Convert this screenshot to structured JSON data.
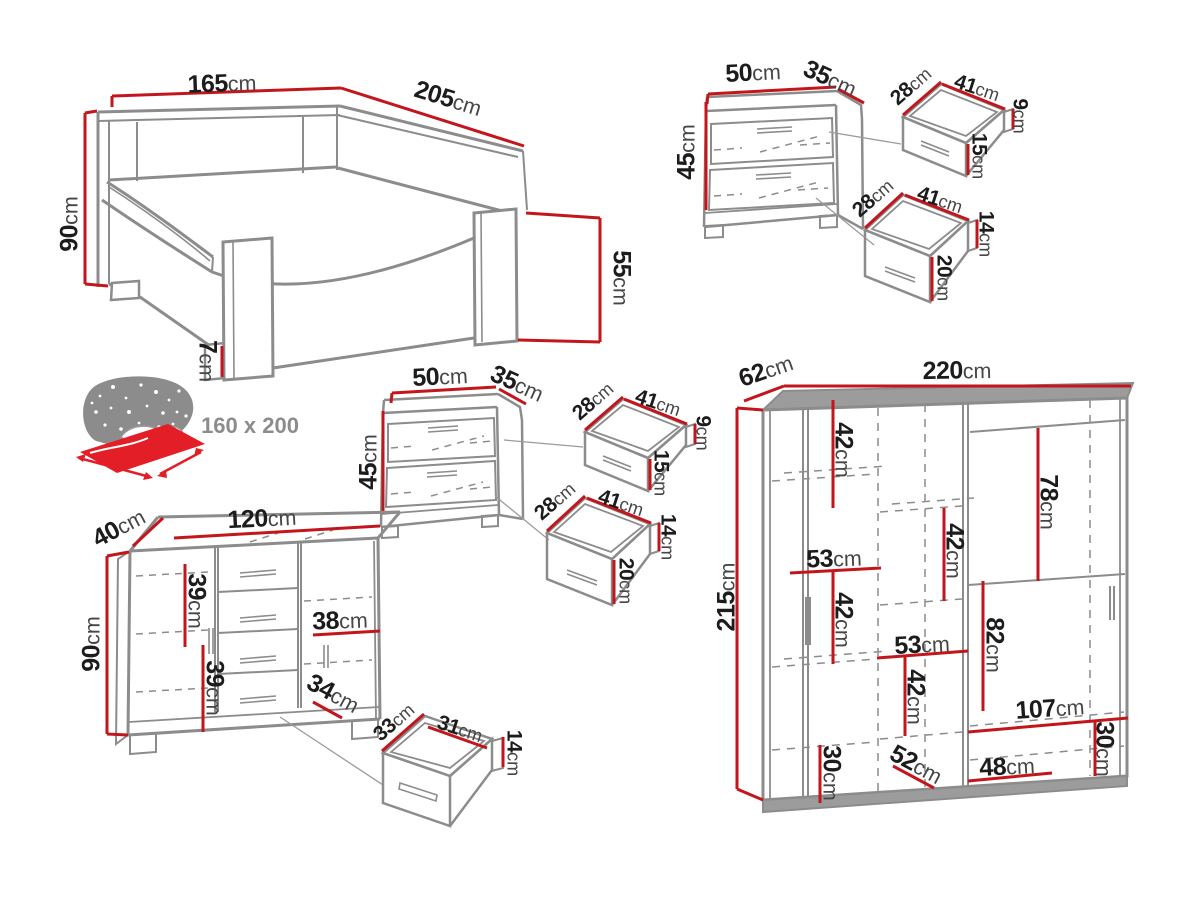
{
  "unit": "cm",
  "colors": {
    "dimension_red": "#c3161c",
    "outline_gray": "#8c8c8c",
    "mattress_red": "#e31e26",
    "text": "#1c1c1c",
    "label_gray": "#8c8c8c"
  },
  "bed": {
    "width": "165",
    "length": "205",
    "headboard_height": "90",
    "footboard_height": "55",
    "leg_height": "7",
    "mattress_size": "160 x 200"
  },
  "nightstand_top": {
    "width": "50",
    "depth": "35",
    "height": "45",
    "top_drawer": {
      "depth": "28",
      "width": "41",
      "back_height": "9",
      "front_height": "15"
    },
    "bottom_drawer": {
      "depth": "28",
      "width": "41",
      "back_height": "14",
      "front_height": "20"
    }
  },
  "nightstand_mid": {
    "width": "50",
    "depth": "35",
    "height": "45",
    "top_drawer": {
      "depth": "28",
      "width": "41",
      "back_height": "9",
      "front_height": "15"
    },
    "bottom_drawer": {
      "depth": "28",
      "width": "41",
      "back_height": "14",
      "front_height": "20"
    }
  },
  "dresser": {
    "depth": "40",
    "width": "120",
    "height": "90",
    "upper_shelf": "39",
    "lower_shelf": "39",
    "door_width": "38",
    "lower_door_width": "34",
    "drawer": {
      "depth": "33",
      "width": "31",
      "height": "14"
    }
  },
  "wardrobe": {
    "depth": "62",
    "width": "220",
    "height": "215",
    "shelf_top": "42",
    "shelf_mid": "42",
    "hanging_right_top": "78",
    "left_section_width": "53",
    "shelf_left_lower": "42",
    "mid_section_width": "53",
    "shelf_mid_lower": "42",
    "hanging_right_mid": "82",
    "bottom_right_width": "107",
    "bottom_right_height": "30",
    "bottom_left_height": "30",
    "bottom_depth": "52",
    "bottom_mid_width": "48"
  }
}
